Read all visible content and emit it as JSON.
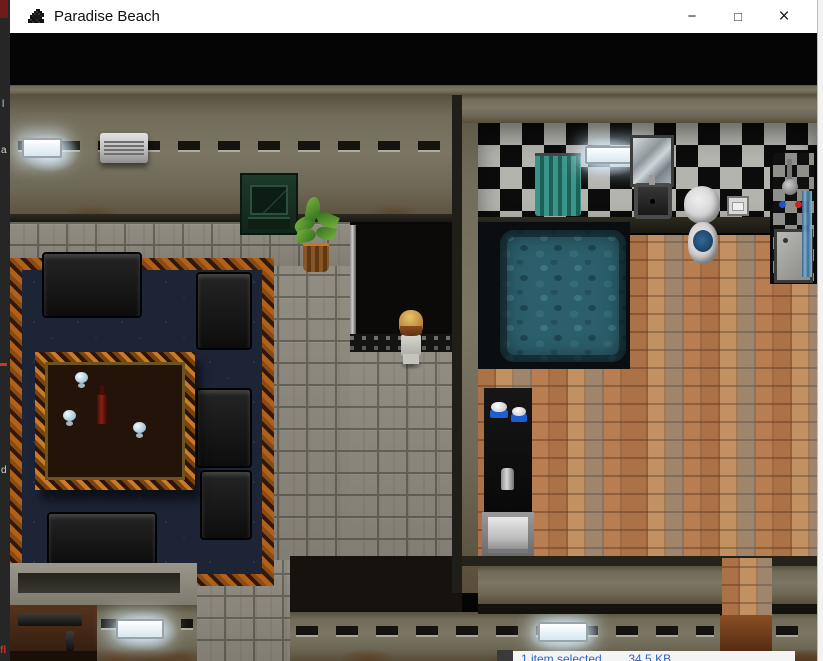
{
  "window": {
    "title": "Paradise Beach",
    "controls": {
      "minimize": "−",
      "maximize": "□",
      "close": "×"
    }
  },
  "status_bar": {
    "text": "1 item selected        34.5 KB"
  },
  "left_edge": {
    "fragments": [
      {
        "text": "l"
      },
      {
        "text": "a"
      },
      {
        "text": "d"
      },
      {
        "text": "fl"
      }
    ]
  },
  "palette": {
    "titlebar": "#ffffff",
    "letterbox": "#000000",
    "wall_olive": "#716c59",
    "floor_stone": "#9b968b",
    "carpet_navy": "#1c2436",
    "carpet_border_orange": "#b06018",
    "checker_light": "#b4b4ae",
    "checker_dark": "#0c0c0c",
    "floor_terracotta": "#bd8a5c",
    "bath_teal": "#2c5f6b",
    "curtain_teal": "#39958a",
    "status_text_blue": "#2f5fd0"
  },
  "game": {
    "player": {
      "description": "blond-haired character facing north in hallway doorway"
    },
    "living_room_objects": [
      "wall-light",
      "air-conditioner",
      "tv-cabinet",
      "potted-plant",
      "area-rug",
      "coffee-table",
      "wine-bottle",
      "wine-glasses",
      "sofas",
      "armchairs",
      "ledge",
      "sideboard-desk",
      "stereo-equipment",
      "bottom-wall-light"
    ],
    "bathroom_objects": [
      "shower-curtain",
      "fluorescent-tube-light",
      "mirror",
      "wash-basin",
      "toilet",
      "toilet-paper-holder",
      "shower-stall",
      "sunken-bathtub",
      "dark-counter-with-bowls",
      "towel-rack",
      "wooden-bench",
      "bottom-wall-light"
    ]
  }
}
